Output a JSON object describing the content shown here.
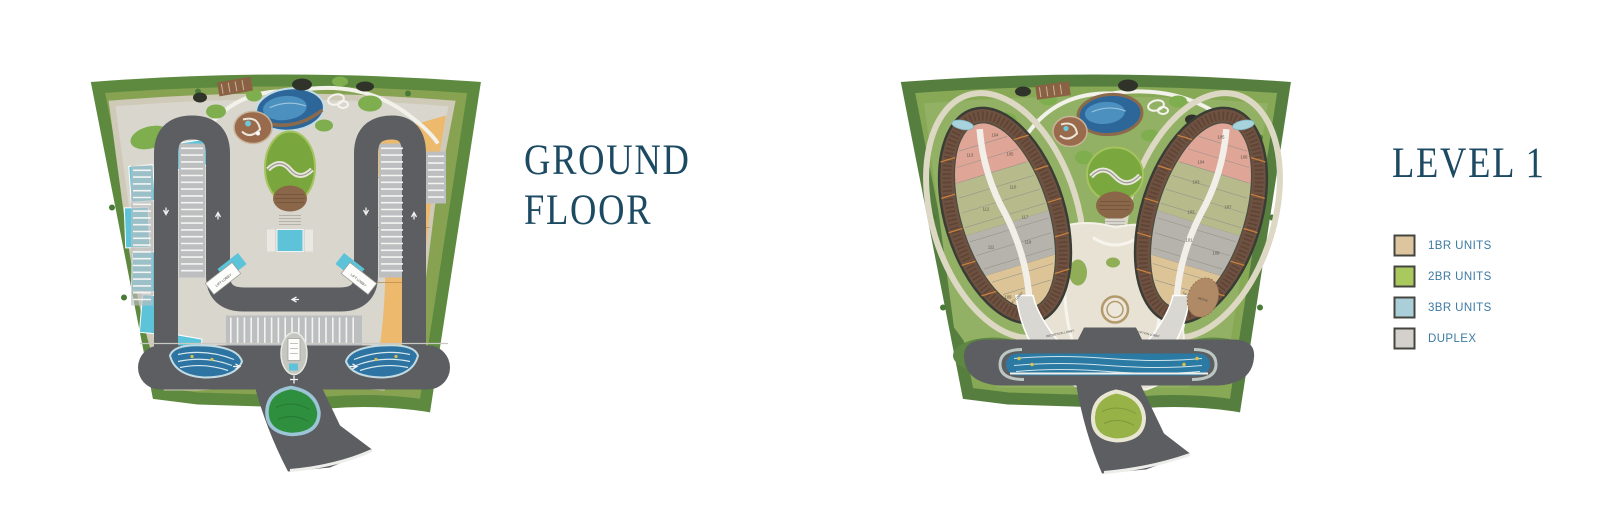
{
  "left_panel": {
    "title_lines": [
      "GROUND",
      "FLOOR"
    ],
    "plan": {
      "lift_lobby_left": "LIFT LOBBY",
      "lift_lobby_right": "LIFT LOBBY"
    }
  },
  "right_panel": {
    "title": "LEVEL 1",
    "plan": {
      "lift_lobby_left": "LIFT LOBBY",
      "lift_lobby_right": "LIFT LOBBY",
      "reception_lobby_left": "RECEPTION LOBBY",
      "reception_lobby_right": "RECEPTION LOBBY",
      "retail": "RETAIL",
      "left_wing_units": [
        "104",
        "113",
        "105",
        "110",
        "112",
        "117",
        "111",
        "118",
        "109"
      ],
      "right_wing_units": [
        "105",
        "104",
        "106",
        "103",
        "102",
        "107",
        "101",
        "108"
      ]
    },
    "legend": {
      "items": [
        {
          "label": "1BR UNITS",
          "color": "#ddc69f"
        },
        {
          "label": "2BR UNITS",
          "color": "#a9c95f"
        },
        {
          "label": "3BR UNITS",
          "color": "#aacfd9"
        },
        {
          "label": "DUPLEX",
          "color": "#d4d1cc"
        }
      ]
    }
  },
  "colors": {
    "title_text": "#1c4a63",
    "legend_text": "#3c7aa2",
    "legend_swatch_border": "#45453f",
    "road": "#5c5e62",
    "pool_water": "#5ec2d8",
    "lagoon_water": "#2d679a",
    "canal_water": "#2a7aa4",
    "lawn": "#79a73d",
    "sand": "#ecb96d",
    "wood_deck": "#6e5140",
    "landscape_green": "#87a351",
    "unit_salmon": "#dfa596",
    "unit_olive": "#b7bb8c",
    "unit_gray": "#b6b3ac",
    "unit_tan": "#dcc497"
  }
}
